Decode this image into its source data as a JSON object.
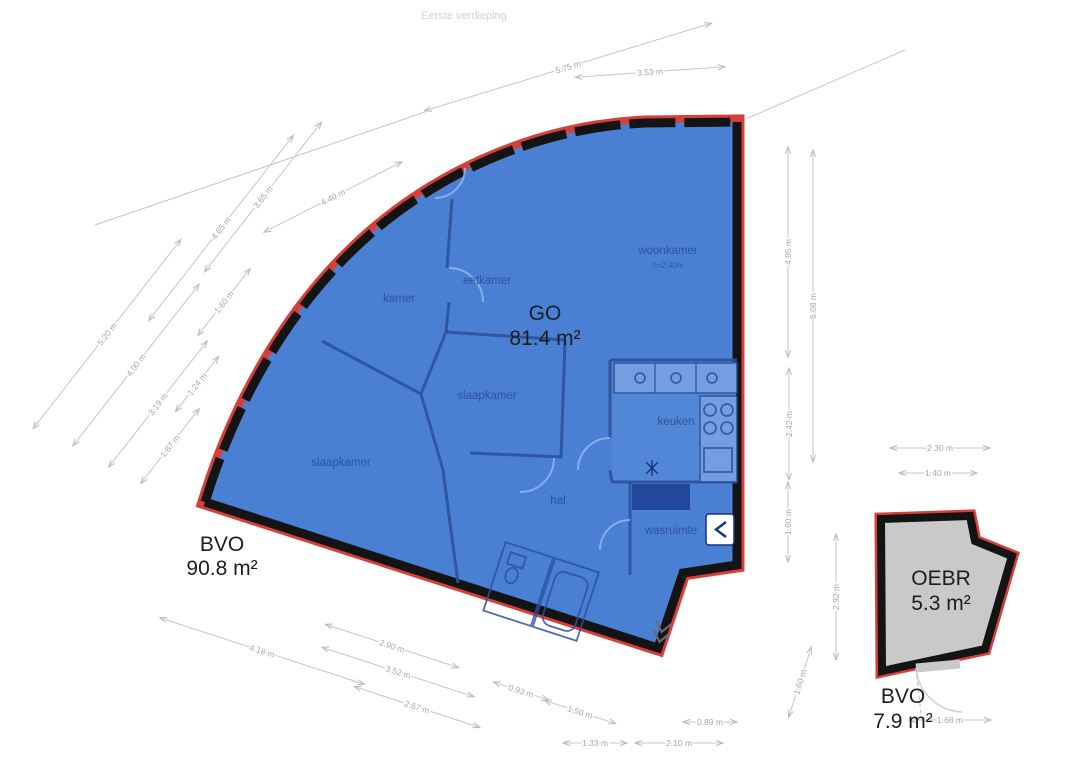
{
  "title": "Eerste verdieping",
  "colors": {
    "plan_fill_blue": "#4a80d4",
    "outline_red": "#d6403b",
    "wall_black": "#141414",
    "oebr_fill_gray": "#c9c9c9",
    "dimension_gray": "#a6a6a6",
    "room_label_blue": "#2a4a94"
  },
  "areas": {
    "go": {
      "code": "GO",
      "value": "81.4 m²"
    },
    "bvo_main": {
      "code": "BVO",
      "value": "90.8 m²"
    },
    "oebr": {
      "code": "OEBR",
      "value": "5.3 m²"
    },
    "bvo_oebr": {
      "code": "BVO",
      "value": "7.9 m²"
    }
  },
  "rooms": [
    {
      "name": "woonkamer",
      "sub": "h=2.40m",
      "x": 668,
      "y": 254
    },
    {
      "name": "eetkamer",
      "x": 487,
      "y": 284
    },
    {
      "name": "kamer",
      "x": 399,
      "y": 302
    },
    {
      "name": "slaapkamer",
      "x": 487,
      "y": 399
    },
    {
      "name": "slaapkamer",
      "x": 341,
      "y": 466
    },
    {
      "name": "keuken",
      "x": 676,
      "y": 425
    },
    {
      "name": "hal",
      "x": 558,
      "y": 504
    },
    {
      "name": "wasruimte",
      "x": 671,
      "y": 534
    }
  ],
  "dimensions": [
    {
      "label": "5.75 m",
      "x": 568,
      "y": 67,
      "rot": -17,
      "len": 300
    },
    {
      "label": "3.53 m",
      "x": 650,
      "y": 72,
      "rot": -4,
      "len": 150
    },
    {
      "label": "5.20 m",
      "x": 107,
      "y": 334,
      "rot": -52,
      "len": 240
    },
    {
      "label": "4.00 m",
      "x": 136,
      "y": 365,
      "rot": -52,
      "len": 205
    },
    {
      "label": "3.19 m",
      "x": 158,
      "y": 404,
      "rot": -52,
      "len": 160
    },
    {
      "label": "1.87 m",
      "x": 170,
      "y": 446,
      "rot": -52,
      "len": 95
    },
    {
      "label": "1.24 m",
      "x": 197,
      "y": 384,
      "rot": -52,
      "len": 70
    },
    {
      "label": "1.60 m",
      "x": 224,
      "y": 302,
      "rot": -52,
      "len": 85
    },
    {
      "label": "4.65 m",
      "x": 221,
      "y": 228,
      "rot": -52,
      "len": 235
    },
    {
      "label": "3.65 m",
      "x": 263,
      "y": 197,
      "rot": -52,
      "len": 190
    },
    {
      "label": "4.40 m",
      "x": 333,
      "y": 197,
      "rot": -27,
      "len": 155
    },
    {
      "label": "4.95 m",
      "x": 788,
      "y": 252,
      "rot": -90,
      "len": 210
    },
    {
      "label": "2.42 m",
      "x": 789,
      "y": 424,
      "rot": -90,
      "len": 112
    },
    {
      "label": "1.60 m",
      "x": 788,
      "y": 522,
      "rot": -90,
      "len": 80
    },
    {
      "label": "6.08 m",
      "x": 813,
      "y": 306,
      "rot": -90,
      "len": 312
    },
    {
      "label": "2.92 m",
      "x": 836,
      "y": 597,
      "rot": -90,
      "len": 126
    },
    {
      "label": "1.60 m",
      "x": 800,
      "y": 682,
      "rot": -72,
      "len": 74
    },
    {
      "label": "2.30 m",
      "x": 940,
      "y": 448,
      "rot": 0,
      "len": 100
    },
    {
      "label": "1.40 m",
      "x": 938,
      "y": 473,
      "rot": 0,
      "len": 78
    },
    {
      "label": "1.68 m",
      "x": 950,
      "y": 720,
      "rot": 0,
      "len": 82
    },
    {
      "label": "4.18 m",
      "x": 262,
      "y": 651,
      "rot": 18,
      "len": 215
    },
    {
      "label": "2.90 m",
      "x": 392,
      "y": 646,
      "rot": 18,
      "len": 140
    },
    {
      "label": "3.52 m",
      "x": 398,
      "y": 672,
      "rot": 18,
      "len": 160
    },
    {
      "label": "2.67 m",
      "x": 417,
      "y": 707,
      "rot": 18,
      "len": 132
    },
    {
      "label": "0.93 m",
      "x": 521,
      "y": 691,
      "rot": 18,
      "len": 58
    },
    {
      "label": "1.50 m",
      "x": 580,
      "y": 712,
      "rot": 18,
      "len": 75
    },
    {
      "label": "1.33 m",
      "x": 595,
      "y": 743,
      "rot": 0,
      "len": 64
    },
    {
      "label": "2.10 m",
      "x": 679,
      "y": 743,
      "rot": 0,
      "len": 88
    },
    {
      "label": "0.89 m",
      "x": 710,
      "y": 722,
      "rot": 0,
      "len": 54
    }
  ]
}
